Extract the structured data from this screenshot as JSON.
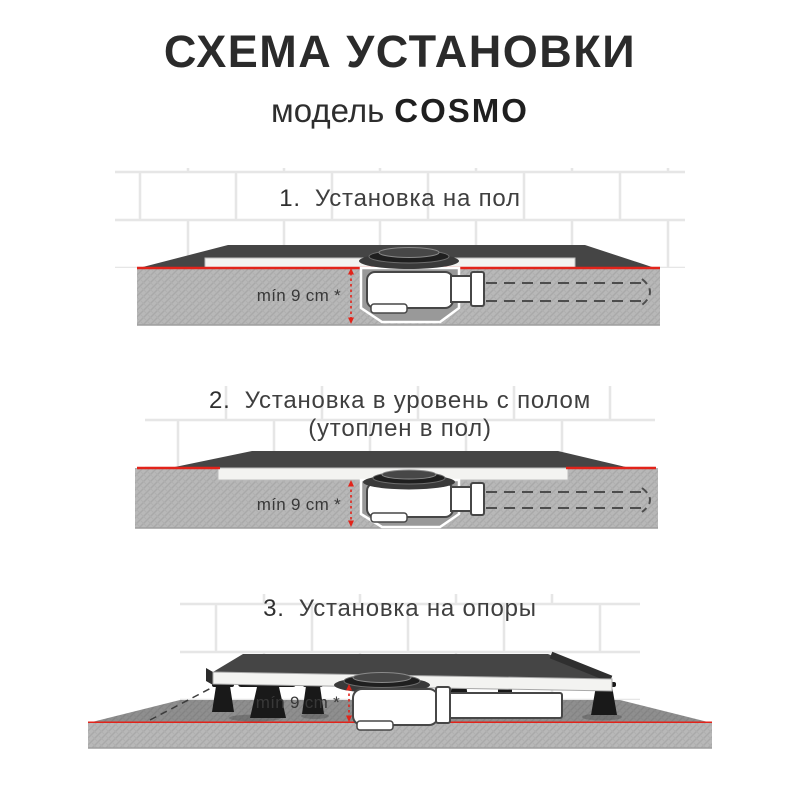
{
  "header": {
    "title": "СХЕМА УСТАНОВКИ",
    "model_label": "модель",
    "model_name": "COSMO"
  },
  "sections": [
    {
      "number": "1.",
      "title": "Установка на пол",
      "subtitle": "",
      "dimension": "mín 9 cm *"
    },
    {
      "number": "2.",
      "title": "Установка в уровень с полом",
      "subtitle": "(утоплен в пол)",
      "dimension": "mín 9 cm *"
    },
    {
      "number": "3.",
      "title": "Установка на опоры",
      "subtitle": "",
      "dimension": "mín 9 cm *"
    }
  ],
  "colors": {
    "accent_red": "#e2231a",
    "tray_dark": "#454545",
    "floor_gray": "#b8b8b8",
    "floor_top_gray": "#8f8f8f",
    "tile_grout": "#e6e6e6",
    "siphon_white": "#ffffff",
    "text_dark": "#2b2b2b"
  }
}
